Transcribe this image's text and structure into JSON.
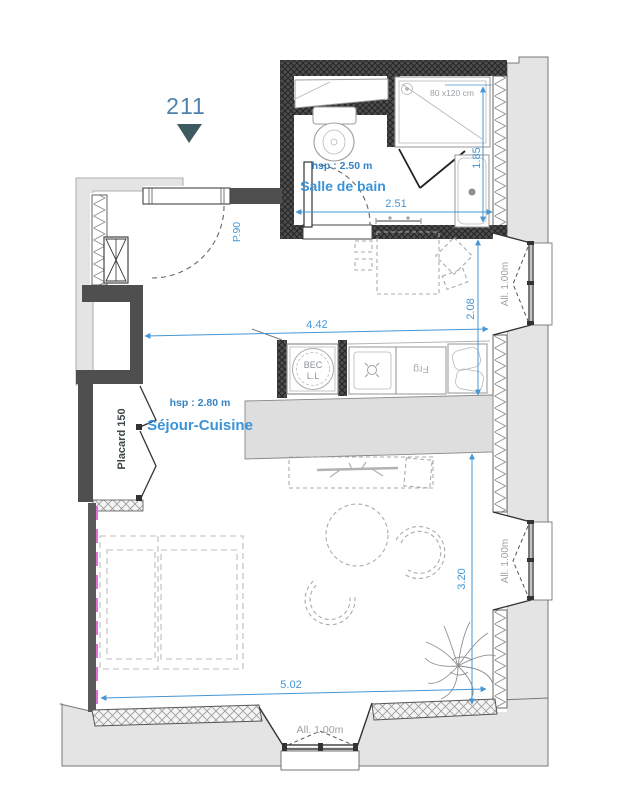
{
  "unit": {
    "number": "211"
  },
  "rooms": {
    "bathroom": {
      "name": "Salle de bain",
      "ceiling_height": "hsp : 2.50 m"
    },
    "living": {
      "name": "Séjour-Cuisine",
      "ceiling_height": "hsp : 2.80 m"
    },
    "closet": {
      "name": "Placard 150"
    }
  },
  "doors": {
    "entry": "P.90"
  },
  "fixtures": {
    "shower_size": "80 x120 cm",
    "washer_line1": "BEC",
    "washer_line2": "L.L",
    "fridge": "Frg"
  },
  "windows": {
    "sill_label": "All. 1.00m"
  },
  "dimensions": {
    "bathroom_width": "2.51",
    "bathroom_depth": "1.85",
    "dining_width": "4.42",
    "dining_depth": "2.08",
    "living_depth": "3.20",
    "living_width": "5.02"
  },
  "colors": {
    "dimension_blue": "#4596d3",
    "room_label_blue": "#3b93d8",
    "unit_label_blue": "#4e82ad",
    "marker_triangle": "#3d5a60",
    "annotation_gray": "#9ba1a6",
    "heater_pink": "#e06fd8",
    "exterior_gray": "#e4e4e4",
    "wall_dark": "#4f4f4f"
  }
}
